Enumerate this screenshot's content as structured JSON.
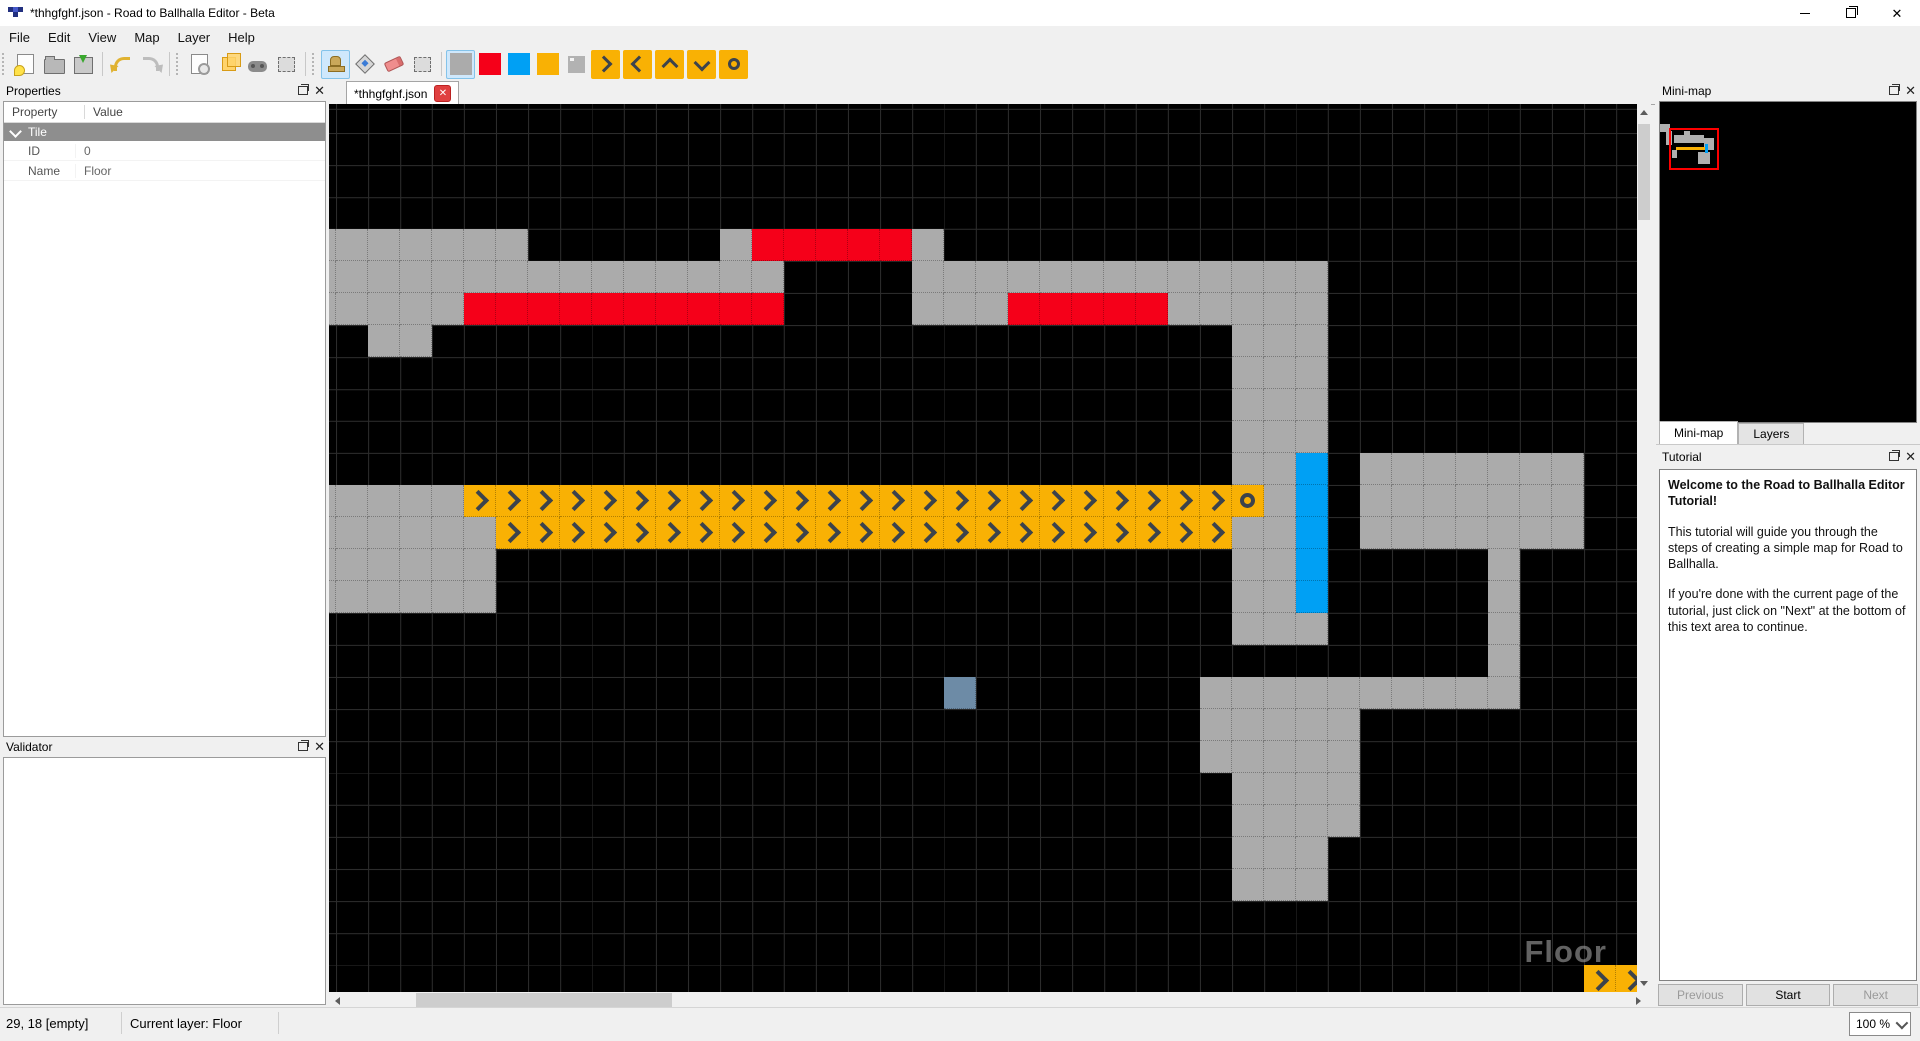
{
  "window": {
    "title": "*thhgfghf.json - Road to Ballhalla Editor - Beta"
  },
  "menu": [
    "File",
    "Edit",
    "View",
    "Map",
    "Layer",
    "Help"
  ],
  "toolbar": {
    "icons": [
      "new-file-icon",
      "open-file-icon",
      "save-file-icon",
      "undo-icon",
      "redo-icon",
      "validate-map-icon",
      "tile-layers-icon",
      "test-map-icon",
      "select-region-icon",
      "stamp-tool-icon",
      "fill-tool-icon",
      "eraser-tool-icon",
      "rect-select-icon",
      "gray-tile-swatch",
      "red-tile-swatch",
      "blue-tile-swatch",
      "orange-tile-swatch",
      "empty-tile-swatch",
      "arrow-right-tile",
      "arrow-left-tile",
      "arrow-up-tile",
      "arrow-down-tile",
      "circle-tile"
    ],
    "active": [
      "stamp-tool-icon",
      "gray-tile-swatch"
    ]
  },
  "tab": {
    "label": "*thhgfghf.json"
  },
  "properties_panel": {
    "title": "Properties",
    "columns": [
      "Property",
      "Value"
    ],
    "group": "Tile",
    "rows": [
      {
        "property": "ID",
        "value": "0"
      },
      {
        "property": "Name",
        "value": "Floor"
      }
    ]
  },
  "validator_panel": {
    "title": "Validator"
  },
  "minimap_panel": {
    "title": "Mini-map",
    "tabs": [
      "Mini-map",
      "Layers"
    ],
    "active_tab": "Mini-map"
  },
  "tutorial_panel": {
    "title": "Tutorial",
    "heading": "Welcome to the Road to Ballhalla Editor Tutorial!",
    "paragraphs": [
      "This tutorial will guide you through the steps of creating a simple map for Road to Ballhalla.",
      "If you're done with the current page of the tutorial, just click on \"Next\" at the bottom of this text area to continue."
    ],
    "buttons": [
      {
        "label": "Previous",
        "enabled": false
      },
      {
        "label": "Start",
        "enabled": true
      },
      {
        "label": "Next",
        "enabled": false
      }
    ]
  },
  "status_bar": {
    "coords": "29, 18 [empty]",
    "layer": "Current layer: Floor",
    "zoom": "100 %"
  },
  "canvas": {
    "watermark": "Floor",
    "tile_size": 32,
    "origin": {
      "x": 7,
      "y": -3
    },
    "tiles": [
      {
        "c": -1,
        "r": 4,
        "w": 7,
        "h": 1,
        "t": "g"
      },
      {
        "c": 12,
        "r": 4,
        "w": 1,
        "h": 1,
        "t": "g"
      },
      {
        "c": 13,
        "r": 4,
        "w": 5,
        "h": 1,
        "t": "r"
      },
      {
        "c": 18,
        "r": 4,
        "w": 1,
        "h": 1,
        "t": "g"
      },
      {
        "c": -1,
        "r": 5,
        "w": 15,
        "h": 1,
        "t": "g"
      },
      {
        "c": 18,
        "r": 5,
        "w": 13,
        "h": 1,
        "t": "g"
      },
      {
        "c": -1,
        "r": 6,
        "w": 5,
        "h": 1,
        "t": "g"
      },
      {
        "c": 4,
        "r": 6,
        "w": 10,
        "h": 1,
        "t": "r"
      },
      {
        "c": 18,
        "r": 6,
        "w": 3,
        "h": 1,
        "t": "g"
      },
      {
        "c": 21,
        "r": 6,
        "w": 5,
        "h": 1,
        "t": "r"
      },
      {
        "c": 26,
        "r": 6,
        "w": 5,
        "h": 1,
        "t": "g"
      },
      {
        "c": 1,
        "r": 7,
        "w": 2,
        "h": 1,
        "t": "g"
      },
      {
        "c": 28,
        "r": 7,
        "w": 3,
        "h": 4,
        "t": "g"
      },
      {
        "c": 28,
        "r": 11,
        "w": 2,
        "h": 1,
        "t": "g"
      },
      {
        "c": 30,
        "r": 11,
        "w": 1,
        "h": 5,
        "t": "b"
      },
      {
        "c": 32,
        "r": 11,
        "w": 7,
        "h": 3,
        "t": "g"
      },
      {
        "c": -1,
        "r": 12,
        "w": 5,
        "h": 1,
        "t": "g"
      },
      {
        "c": 4,
        "r": 12,
        "w": 24,
        "h": 1,
        "t": "a"
      },
      {
        "c": 28,
        "r": 12,
        "w": 1,
        "h": 1,
        "t": "O"
      },
      {
        "c": 29,
        "r": 12,
        "w": 1,
        "h": 1,
        "t": "g"
      },
      {
        "c": -1,
        "r": 13,
        "w": 6,
        "h": 1,
        "t": "g"
      },
      {
        "c": 5,
        "r": 13,
        "w": 23,
        "h": 1,
        "t": "a"
      },
      {
        "c": 28,
        "r": 13,
        "w": 2,
        "h": 1,
        "t": "g"
      },
      {
        "c": -1,
        "r": 14,
        "w": 6,
        "h": 2,
        "t": "g"
      },
      {
        "c": 28,
        "r": 14,
        "w": 2,
        "h": 2,
        "t": "g"
      },
      {
        "c": 36,
        "r": 14,
        "w": 1,
        "h": 4,
        "t": "g"
      },
      {
        "c": 28,
        "r": 16,
        "w": 3,
        "h": 1,
        "t": "g"
      },
      {
        "c": 19,
        "r": 18,
        "w": 1,
        "h": 1,
        "t": "s"
      },
      {
        "c": 27,
        "r": 18,
        "w": 10,
        "h": 1,
        "t": "g"
      },
      {
        "c": 27,
        "r": 19,
        "w": 5,
        "h": 2,
        "t": "g"
      },
      {
        "c": 28,
        "r": 21,
        "w": 4,
        "h": 2,
        "t": "g"
      },
      {
        "c": 28,
        "r": 23,
        "w": 3,
        "h": 2,
        "t": "g"
      },
      {
        "c": 39,
        "r": 27,
        "w": 2,
        "h": 1,
        "t": "a"
      }
    ]
  },
  "colors": {
    "gray": "#ababab",
    "red": "#f50019",
    "orange": "#f9b104",
    "blue": "#00a0f4",
    "steel": "#6d8ba6",
    "glyph": "#3c434c",
    "minimap_viewport": "#ff0000"
  }
}
